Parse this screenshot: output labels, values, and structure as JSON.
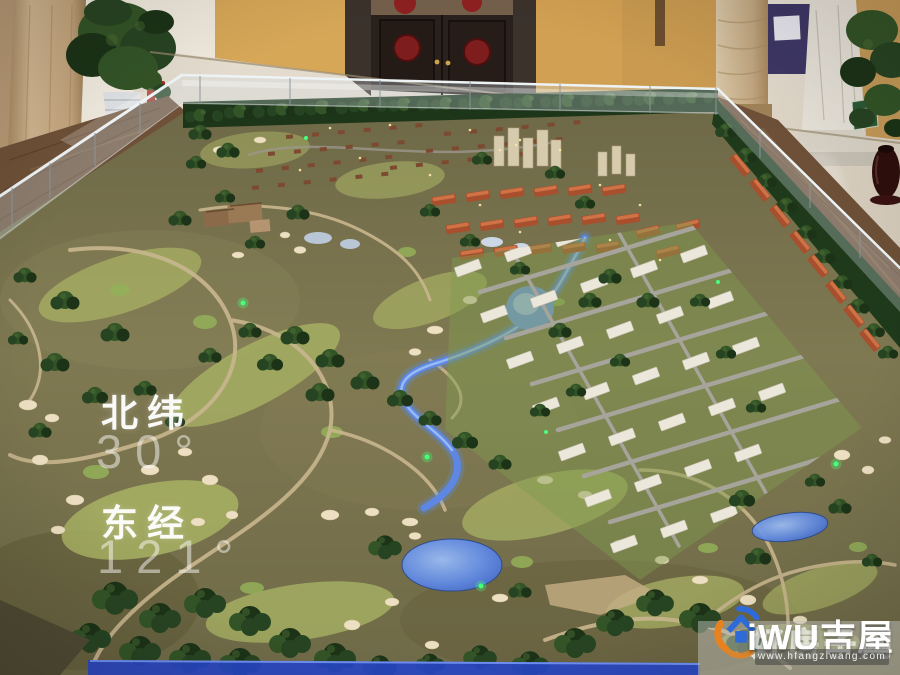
{
  "overlay": {
    "latitude_label": "北纬",
    "latitude_value": "30°",
    "longitude_label": "东经",
    "longitude_value": "121°"
  },
  "watermark": {
    "brand": "iWU吉屋",
    "brand_overlay": "好房子网",
    "url": "www.hfangziwang.com"
  },
  "colors": {
    "water": "#5d87e2",
    "water_glow": "#9dc0f6",
    "fairway": "#a8b164",
    "terrain": "#787250",
    "trees": "#2c4a24",
    "sand": "#ecdfc2",
    "path": "#c9b68e",
    "marble_light": "#d9d0c2",
    "marble_brown": "#6d5037",
    "wall_tan": "#d3a156",
    "door_wood": "#2a211c",
    "medallion_red": "#8e2020",
    "led_blue": "#2746c8",
    "logo_orange": "#e8821e",
    "logo_blue": "#2f6bd8"
  }
}
